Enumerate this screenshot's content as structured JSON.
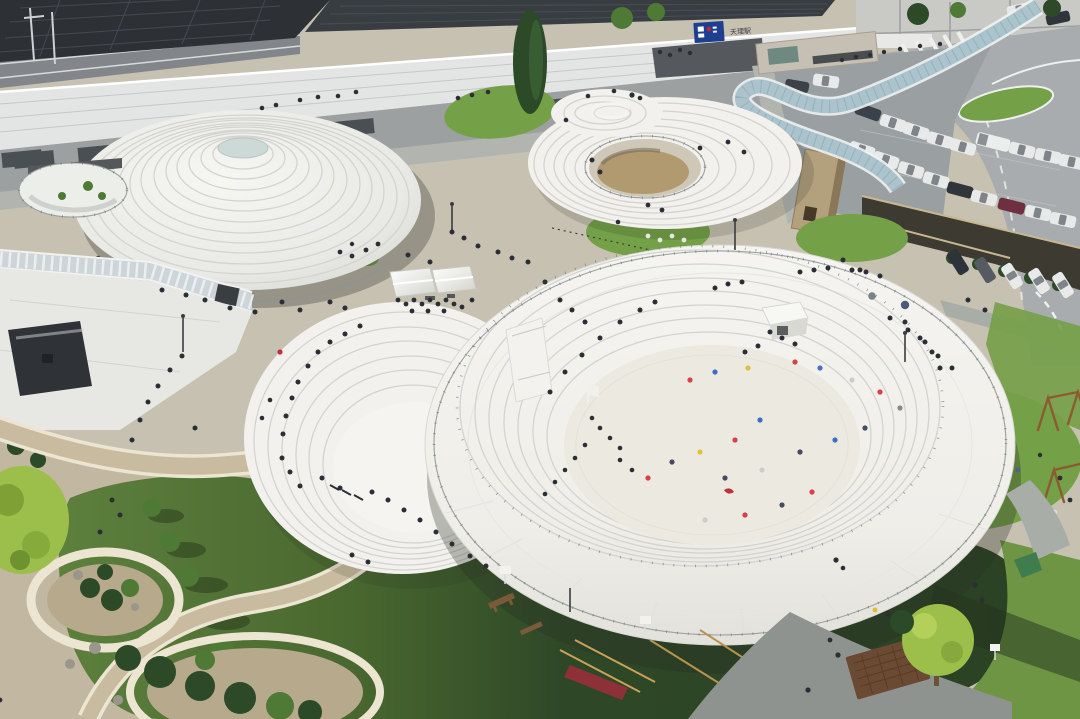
{
  "meta": {
    "title": "Aerial photograph of a railway-station plaza with white circular stepped structures",
    "type": "photograph",
    "regions": [
      "train-station-building",
      "elevated-walkway",
      "parking-lot",
      "access-road",
      "covered-walkway-canopy",
      "ribbed-dome-pavilion",
      "crater-play-mound",
      "stepped-amphitheater",
      "play-bowl-with-disc-roof",
      "lawns",
      "playground",
      "stone-edged-paths",
      "planting-beds"
    ]
  },
  "station": {
    "sign_label": "天理駅"
  },
  "scene": {
    "white_tents": 2,
    "swing_sets": 2,
    "event_canopy_color": "white"
  },
  "palette": {
    "pavement": "#c7c1b2",
    "pavementWarm": "#bdae93",
    "roofDark": "#2d3136",
    "roofDark2": "#383d42",
    "walkwayWhite": "#e3e5e4",
    "facade": "#9da0a1",
    "sidewalk": "#b2b4b0",
    "road": "#a8acae",
    "asphalt": "#9aa0a2",
    "grass": "#74a047",
    "grassDark": "#2c4425",
    "grassBright": "#6d9544",
    "structWhite": "#f2f1ed",
    "structWhiteDim": "#e6e5e0",
    "ringLine": "#d3d4cf",
    "sand": "#ece9e1",
    "pitFloor": "#b29a70",
    "trench": "#3d3a31",
    "kiosk": "#b3a07d",
    "kioskSide": "#8a7757",
    "charcoal": "#2f3337",
    "glassCorridor": "#cdd5d8",
    "glassCanopy": "#a3bfc9",
    "treeGreen": "#4e7a35",
    "treeDark": "#2c4a28",
    "treeYellow": "#9cbf4b",
    "person": "#2b2e35",
    "railing": "#9aa09f",
    "railDark": "#70757a",
    "woodSwing": "#8a5c30",
    "benchBrown": "#7a5a38",
    "slideRed": "#8e3038",
    "grate": "#6b4a33",
    "stoneEdge": "#ece5d2",
    "signBlue": "#1e3f90",
    "signRed": "#cc2233"
  }
}
